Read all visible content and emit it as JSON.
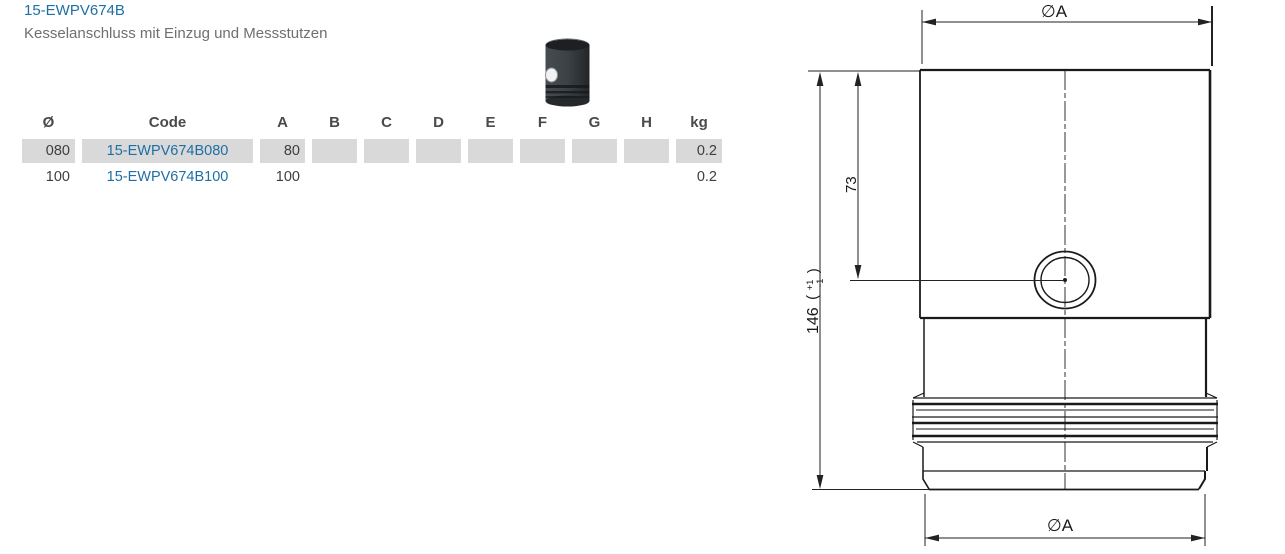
{
  "header": {
    "title": "15-EWPV674B",
    "subtitle": "Kesselanschluss mit Einzug und Messstutzen",
    "accent_color": "#1d6fa5"
  },
  "product_image": {
    "name": "kesselanschluss-thumbnail"
  },
  "table": {
    "cell_bg": "#d9d9d9",
    "link_color": "#1d6fa5",
    "columns": [
      {
        "label": "Ø",
        "width": 53,
        "align": "right"
      },
      {
        "label": "Code",
        "width": 171,
        "align": "center"
      },
      {
        "label": "A",
        "width": 45,
        "align": "right"
      },
      {
        "label": "B",
        "width": 45,
        "align": "right"
      },
      {
        "label": "C",
        "width": 45,
        "align": "right"
      },
      {
        "label": "D",
        "width": 45,
        "align": "right"
      },
      {
        "label": "E",
        "width": 45,
        "align": "right"
      },
      {
        "label": "F",
        "width": 45,
        "align": "right"
      },
      {
        "label": "G",
        "width": 45,
        "align": "right"
      },
      {
        "label": "H",
        "width": 45,
        "align": "right"
      },
      {
        "label": "kg",
        "width": 46,
        "align": "right"
      }
    ],
    "rows": [
      {
        "highlighted": true,
        "cells": [
          "080",
          "15-EWPV674B080",
          "80",
          "",
          "",
          "",
          "",
          "",
          "",
          "",
          "0.2"
        ]
      },
      {
        "highlighted": false,
        "cells": [
          "100",
          "15-EWPV674B100",
          "100",
          "",
          "",
          "",
          "",
          "",
          "",
          "",
          "0.2"
        ]
      }
    ]
  },
  "drawing": {
    "dia_top": "∅A",
    "dia_bottom": "∅A",
    "total_height": "146",
    "tol_open": "(",
    "tol_plus": "+1",
    "tol_minus": "-1",
    "tol_close": ")",
    "nozzle_height": "73"
  }
}
